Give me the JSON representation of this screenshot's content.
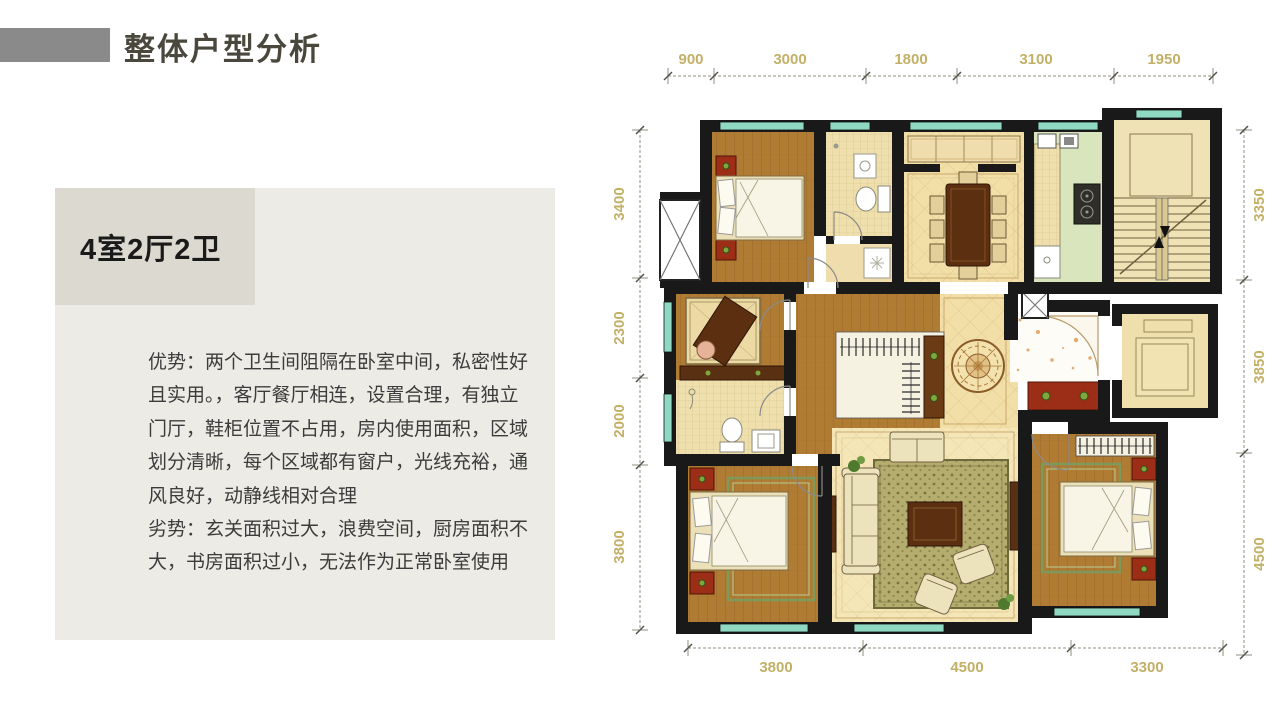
{
  "slide": {
    "accent_color": "#8a8a8a",
    "title": "整体户型分析",
    "panel": {
      "headline": "4室2厅2卫",
      "body_lines": [
        "优势：两个卫生间阻隔在卧室中间，私密性好",
        "且实用。，客厅餐厅相连，设置合理，有独立",
        "门厅，鞋柜位置不占用，房内使用面积，区域",
        "划分清晰，每个区域都有窗户，光线充裕，通",
        "风良好，动静线相对合理",
        "劣势：玄关面积过大，浪费空间，厨房面积不",
        "大，书房面积过小，无法作为正常卧室使用"
      ]
    }
  },
  "floorplan": {
    "dim_top": [
      "900",
      "3000",
      "1800",
      "3100",
      "1950"
    ],
    "dim_left": [
      "3400",
      "2300",
      "2000",
      "3800"
    ],
    "dim_right": [
      "3350",
      "3850",
      "4500"
    ],
    "dim_bottom": [
      "3800",
      "4500",
      "3300"
    ],
    "colors": {
      "wall": "#191919",
      "window": "#8fd9c3",
      "wood_floor": "#b07c33",
      "tile_floor": "#f2dfa8",
      "bath_tile": "#eedfad",
      "kitchen_floor": "#d9e5bd",
      "stair_floor": "#efe3b6",
      "cabinet_red": "#9c2d16",
      "dark_wood": "#5b2f10",
      "dim_text": "#c3b067"
    }
  }
}
